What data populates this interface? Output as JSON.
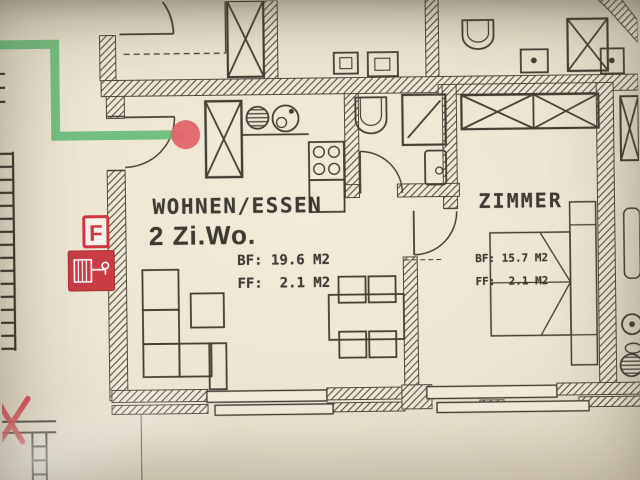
{
  "rooms": {
    "living": {
      "name": "WOHNEN/ESSEN",
      "unit_type": "2 Zi.Wo.",
      "bf": "BF: 19.6 M2",
      "ff": "FF:  2.1 M2"
    },
    "bedroom": {
      "name": "ZIMMER",
      "bf": "BF: 15.7 M2",
      "ff": "FF:  2.1 M2"
    }
  },
  "symbols": {
    "fire_point_letter": "F",
    "hose_reel_icon": "fire-hose-reel-icon",
    "location_marker_icon": "location-dot-icon",
    "escape_route_icon": "escape-route-line",
    "crossed_out_icon": "red-cross-mark",
    "staircase_icon": "staircase-steps"
  },
  "colors": {
    "escape_route_green": "#63b877",
    "marker_red": "#e25f68",
    "safety_red": "#c9363f",
    "paper": "#ece5d3",
    "ink": "#3e382f"
  }
}
